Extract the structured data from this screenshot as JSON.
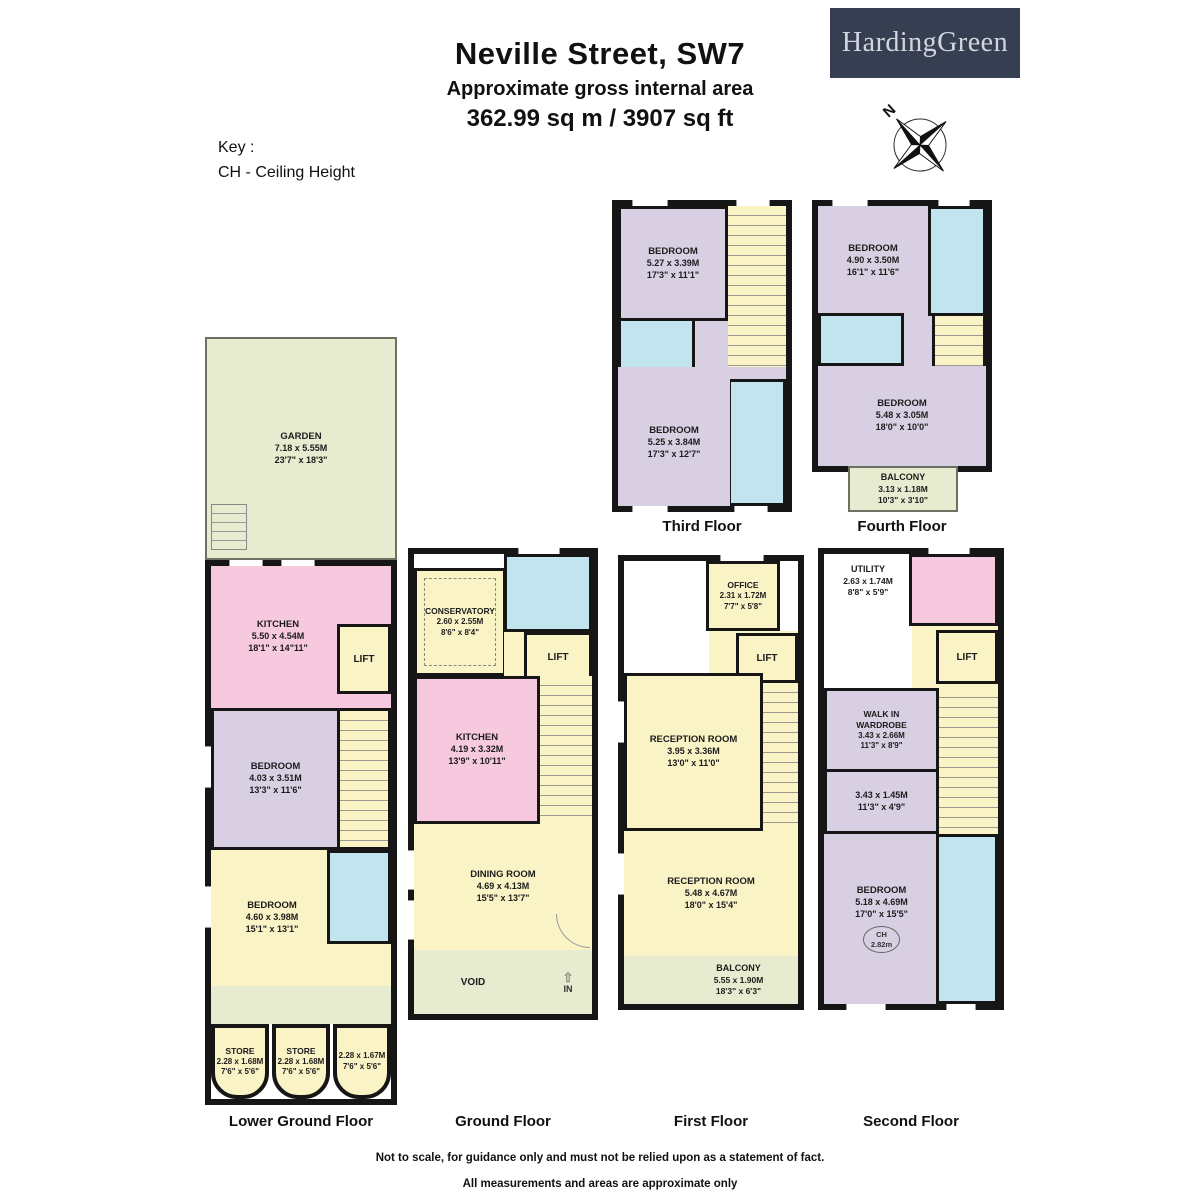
{
  "header": {
    "title": "Neville Street, SW7",
    "subtitle": "Approximate gross internal area",
    "area": "362.99 sq m /  3907 sq ft",
    "logo": "HardingGreen",
    "compass_n": "N",
    "key_title": "Key :",
    "key_ch": "CH - Ceiling Height"
  },
  "colors": {
    "wall": "#161616",
    "room_purple": "#d9cfe3",
    "room_pink": "#f6c9df",
    "room_yellow": "#faf3c6",
    "room_blue": "#c2e4ee",
    "outdoor_green": "#e7ebcf",
    "logo_navy": "#363f52"
  },
  "floors": {
    "lower_ground": {
      "label": "Lower Ground Floor",
      "garden": {
        "name": "GARDEN",
        "m": "7.18 x 5.55M",
        "ft": "23'7\" x 18'3\""
      },
      "kitchen": {
        "name": "KITCHEN",
        "m": "5.50 x 4.54M",
        "ft": "18'1\" x 14\"11\""
      },
      "lift": "LIFT",
      "bedroom1": {
        "name": "BEDROOM",
        "m": "4.03 x 3.51M",
        "ft": "13'3\" x 11'6\""
      },
      "bedroom2": {
        "name": "BEDROOM",
        "m": "4.60 x 3.98M",
        "ft": "15'1\" x 13'1\""
      },
      "store1": {
        "name": "STORE",
        "m": "2.28 x 1.68M",
        "ft": "7'6\" x 5'6\""
      },
      "store2": {
        "name": "STORE",
        "m": "2.28 x 1.68M",
        "ft": "7'6\" x 5'6\""
      },
      "store3": {
        "m": "2.28 x 1.67M",
        "ft": "7'6\" x 5'6\""
      }
    },
    "ground": {
      "label": "Ground Floor",
      "conservatory": {
        "name": "CONSERVATORY",
        "m": "2.60 x 2.55M",
        "ft": "8'6\" x 8'4\""
      },
      "lift": "LIFT",
      "kitchen": {
        "name": "KITCHEN",
        "m": "4.19 x 3.32M",
        "ft": "13'9\" x 10'11\""
      },
      "dining": {
        "name": "DINING ROOM",
        "m": "4.69 x 4.13M",
        "ft": "15'5\" x 13'7\""
      },
      "void_label": "VOID",
      "in_label": "IN",
      "in_arrow": "⇧"
    },
    "first": {
      "label": "First Floor",
      "office": {
        "name": "OFFICE",
        "m": "2.31 x 1.72M",
        "ft": "7'7\" x 5'8\""
      },
      "lift": "LIFT",
      "reception1": {
        "name": "RECEPTION ROOM",
        "m": "3.95 x 3.36M",
        "ft": "13'0\" x 11'0\""
      },
      "reception2": {
        "name": "RECEPTION ROOM",
        "m": "5.48 x 4.67M",
        "ft": "18'0\" x 15'4\""
      },
      "balcony": {
        "name": "BALCONY",
        "m": "5.55 x 1.90M",
        "ft": "18'3\" x 6'3\""
      }
    },
    "second": {
      "label": "Second Floor",
      "utility": {
        "name": "UTILITY",
        "m": "2.63 x 1.74M",
        "ft": "8'8\" x 5'9\""
      },
      "lift": "LIFT",
      "wardrobe": {
        "name": "WALK IN WARDROBE",
        "m": "3.43 x 2.66M",
        "ft": "11'3\" x 8'9\""
      },
      "inner_room": {
        "m": "3.43 x 1.45M",
        "ft": "11'3\" x 4'9\""
      },
      "bedroom": {
        "name": "BEDROOM",
        "m": "5.18 x 4.69M",
        "ft": "17'0\" x 15'5\"",
        "ch_label": "CH",
        "ch_value": "2.82m"
      }
    },
    "third": {
      "label": "Third Floor",
      "bedroom1": {
        "name": "BEDROOM",
        "m": "5.27 x 3.39M",
        "ft": "17'3\" x 11'1\""
      },
      "bedroom2": {
        "name": "BEDROOM",
        "m": "5.25 x 3.84M",
        "ft": "17'3\" x 12'7\""
      }
    },
    "fourth": {
      "label": "Fourth Floor",
      "bedroom1": {
        "name": "BEDROOM",
        "m": "4.90 x 3.50M",
        "ft": "16'1\" x 11'6\""
      },
      "bedroom2": {
        "name": "BEDROOM",
        "m": "5.48 x 3.05M",
        "ft": "18'0\" x 10'0\""
      },
      "balcony": {
        "name": "BALCONY",
        "m": "3.13 x 1.18M",
        "ft": "10'3\" x 3'10\""
      }
    }
  },
  "footer": {
    "line1": "Not to scale, for guidance only and must not be relied upon as a statement of fact.",
    "line2": "All measurements and areas are approximate only"
  }
}
